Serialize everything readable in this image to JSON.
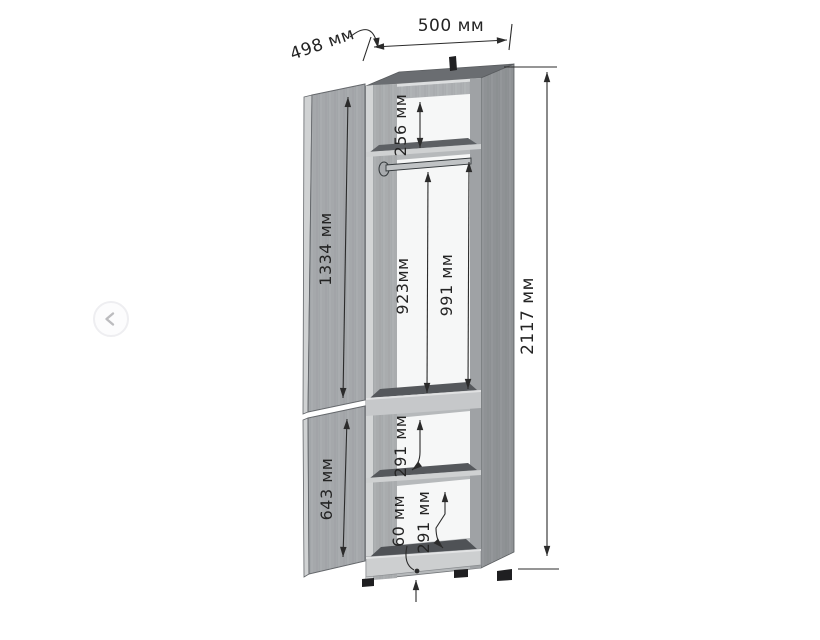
{
  "carousel": {
    "prev_icon": "chevron-left"
  },
  "drawing": {
    "kind": "wardrobe-dimension-diagram",
    "unit": "мм",
    "labels": {
      "top_width": "500 мм",
      "top_depth": "498 мм",
      "total_height": "2117 мм",
      "upper_door": "1334 мм",
      "lower_door": "643 мм",
      "top_compartment": "256 мм",
      "rod_height": "923мм",
      "hanging_compartment": "991 мм",
      "middle_compartment": "291 мм",
      "bottom_compartment": "291 мм",
      "plinth_height": "60 мм"
    },
    "colors": {
      "wood_light": "#c9cbcd",
      "wood_mid": "#a5a8ab",
      "wood_dark": "#6a6d71",
      "shelf_top": "#55585c",
      "interior_white": "#f6f7f7",
      "dimension_ink": "#2b2b2b"
    }
  }
}
